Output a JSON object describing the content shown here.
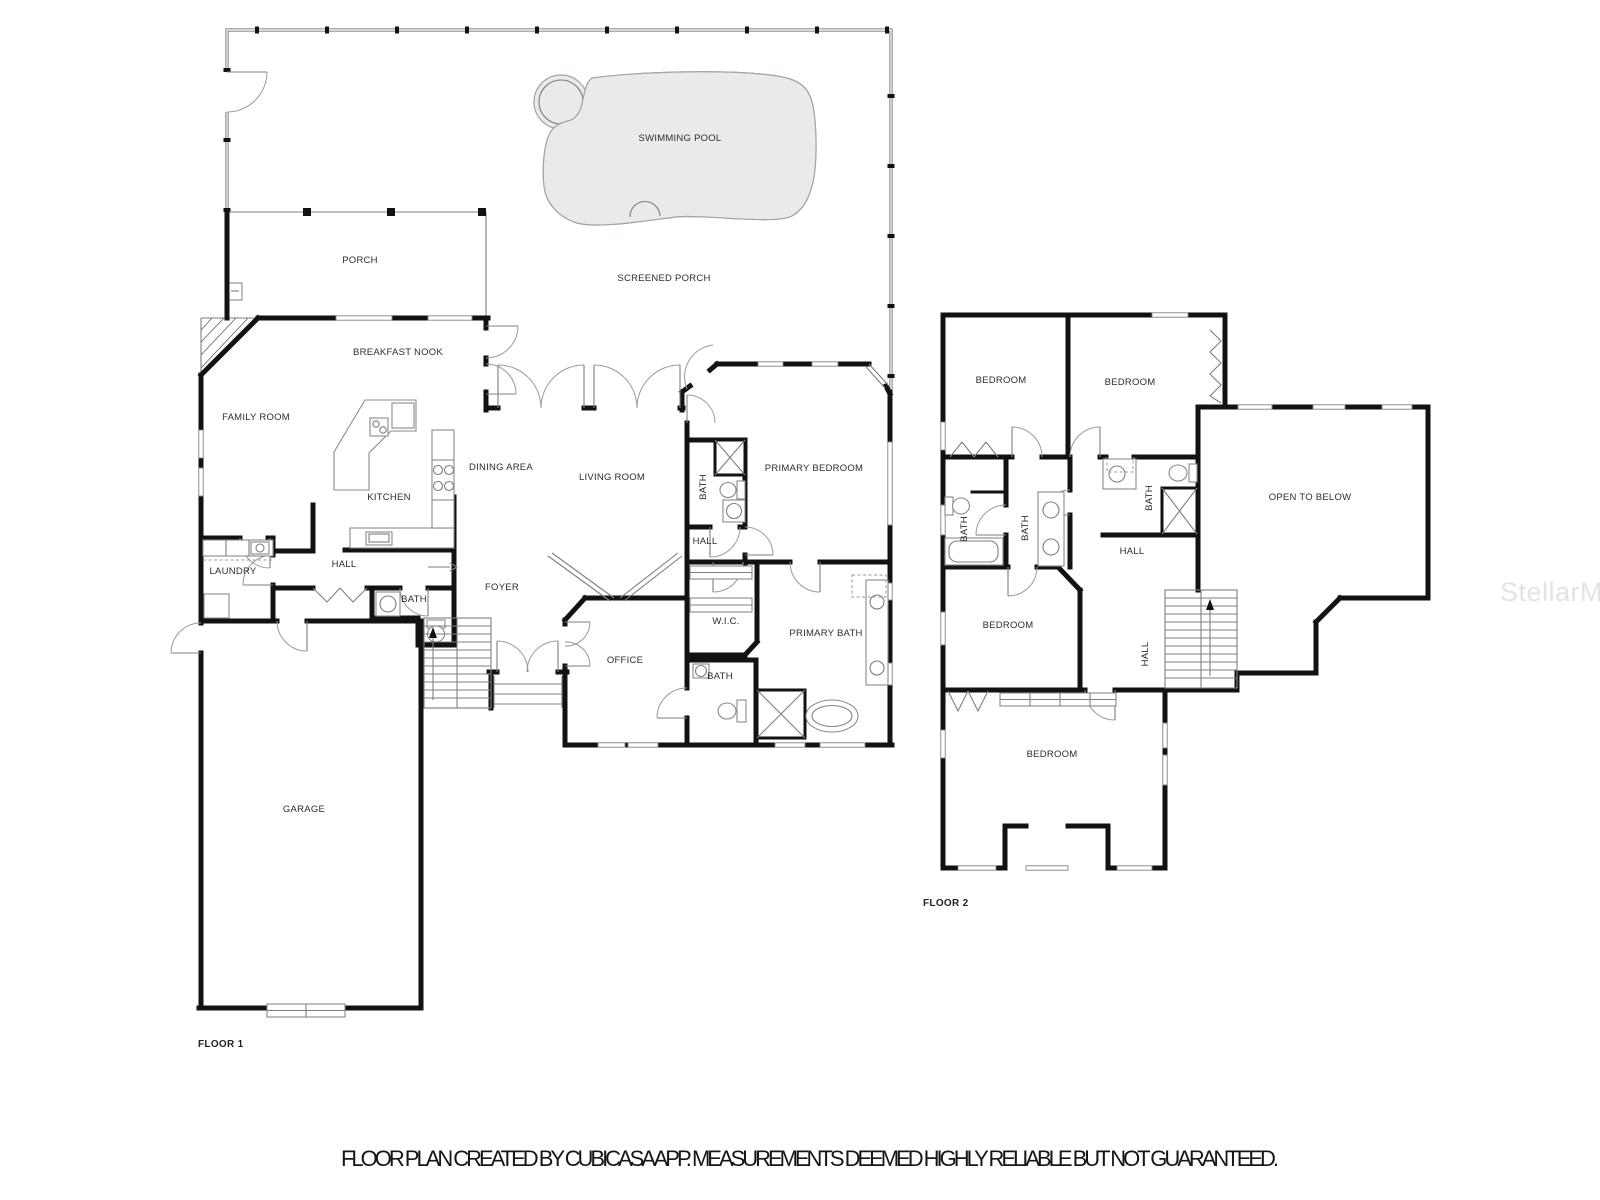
{
  "floor1": {
    "label": "FLOOR 1",
    "rooms": {
      "swimming_pool": "SWIMMING POOL",
      "screened_porch": "SCREENED PORCH",
      "porch": "PORCH",
      "breakfast_nook": "BREAKFAST NOOK",
      "family_room": "FAMILY ROOM",
      "kitchen": "KITCHEN",
      "dining_area": "DINING AREA",
      "living_room": "LIVING ROOM",
      "primary_bedroom": "PRIMARY BEDROOM",
      "suite_bath": "BATH",
      "suite_hall": "HALL",
      "laundry": "LAUNDRY",
      "hall": "HALL",
      "hall_bath": "BATH",
      "foyer": "FOYER",
      "wic": "W.I.C.",
      "primary_bath": "PRIMARY BATH",
      "office": "OFFICE",
      "office_bath": "BATH",
      "garage": "GARAGE"
    }
  },
  "floor2": {
    "label": "FLOOR 2",
    "rooms": {
      "bedroom_a": "BEDROOM",
      "bedroom_b": "BEDROOM",
      "open_to_below": "OPEN TO BELOW",
      "bath_a": "BATH",
      "bath_b": "BATH",
      "bath_c": "BATH",
      "hall": "HALL",
      "bedroom_c": "BEDROOM",
      "stair_hall": "HALL",
      "bedroom_d": "BEDROOM"
    }
  },
  "caption": "FLOOR PLAN CREATED BY CUBICASA APP. MEASUREMENTS DEEMED HIGHLY RELIABLE BUT NOT GUARANTEED.",
  "watermark": "StellarMLS",
  "colors": {
    "wall": "#121212",
    "fixture_line": "#8a8a8a",
    "pool_fill": "#e9ebeb",
    "pool_stroke": "#9fa6a6",
    "label_text": "#2d2d2d",
    "watermark_text": "#e3e3e3"
  }
}
